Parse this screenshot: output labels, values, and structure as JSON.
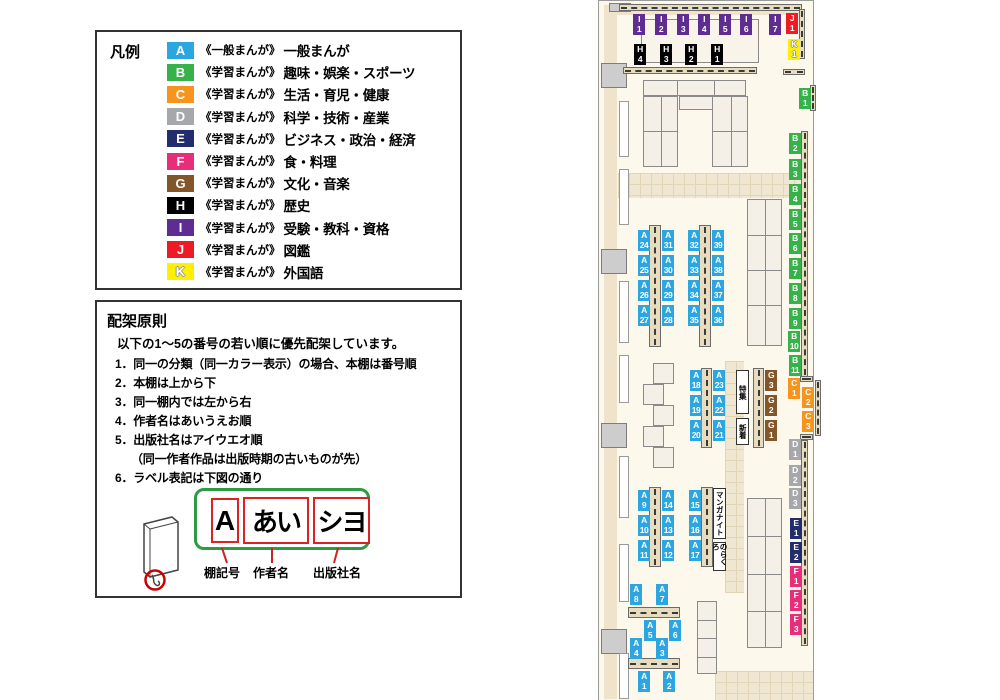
{
  "colors": {
    "A": "#2CA6E0",
    "B": "#35B24A",
    "C": "#F7941E",
    "D": "#A5A7AA",
    "E": "#232C6C",
    "F": "#E62E7B",
    "G": "#82552A",
    "H": "#000000",
    "I": "#5F2D91",
    "J": "#ED1C24",
    "K": "#FFF000"
  },
  "legend": {
    "title": "凡例",
    "items": [
      {
        "code": "A",
        "series": "《一般まんが》",
        "category": "一般まんが"
      },
      {
        "code": "B",
        "series": "《学習まんが》",
        "category": "趣味・娯楽・スポーツ"
      },
      {
        "code": "C",
        "series": "《学習まんが》",
        "category": "生活・育児・健康"
      },
      {
        "code": "D",
        "series": "《学習まんが》",
        "category": "科学・技術・産業"
      },
      {
        "code": "E",
        "series": "《学習まんが》",
        "category": "ビジネス・政治・経済"
      },
      {
        "code": "F",
        "series": "《学習まんが》",
        "category": "食・料理"
      },
      {
        "code": "G",
        "series": "《学習まんが》",
        "category": "文化・音楽"
      },
      {
        "code": "H",
        "series": "《学習まんが》",
        "category": "歴史"
      },
      {
        "code": "I",
        "series": "《学習まんが》",
        "category": "受験・教科・資格"
      },
      {
        "code": "J",
        "series": "《学習まんが》",
        "category": "図鑑"
      },
      {
        "code": "K",
        "series": "《学習まんが》",
        "category": "外国語",
        "light": true
      }
    ]
  },
  "principles": {
    "title": "配架原則",
    "intro": "以下の1～5の番号の若い順に優先配架しています。",
    "items": [
      {
        "t": "1．同一の分類（同一カラー表示）の場合、本棚は番号順"
      },
      {
        "t": "2．本棚は上から下"
      },
      {
        "t": "3．同一棚内では左から右"
      },
      {
        "t": "4．作者名はあいうえお順"
      },
      {
        "t": "5．出版社名はアイウエオ順"
      },
      {
        "t": "（同一作者作品は出版時期の古いものが先）",
        "indent": true
      },
      {
        "t": "6．ラベル表記は下図の通り"
      }
    ],
    "diagram": {
      "shelf_code": "A",
      "author": "あい",
      "publisher": "シヨ",
      "labels": [
        "棚記号",
        "作者名",
        "出版社名"
      ]
    }
  },
  "map": {
    "markers": [
      {
        "c": "I",
        "n": "1",
        "x": 34,
        "y": 13
      },
      {
        "c": "I",
        "n": "2",
        "x": 56,
        "y": 13
      },
      {
        "c": "I",
        "n": "3",
        "x": 78,
        "y": 13
      },
      {
        "c": "I",
        "n": "4",
        "x": 99,
        "y": 13
      },
      {
        "c": "I",
        "n": "5",
        "x": 120,
        "y": 13
      },
      {
        "c": "I",
        "n": "6",
        "x": 141,
        "y": 13
      },
      {
        "c": "I",
        "n": "7",
        "x": 170,
        "y": 13
      },
      {
        "c": "J",
        "n": "1",
        "x": 187,
        "y": 12
      },
      {
        "c": "K",
        "n": "1",
        "x": 189,
        "y": 38
      },
      {
        "c": "H",
        "n": "4",
        "x": 35,
        "y": 43
      },
      {
        "c": "H",
        "n": "3",
        "x": 61,
        "y": 43
      },
      {
        "c": "H",
        "n": "2",
        "x": 86,
        "y": 43
      },
      {
        "c": "H",
        "n": "1",
        "x": 112,
        "y": 43
      },
      {
        "c": "B",
        "n": "1",
        "x": 200,
        "y": 87
      },
      {
        "c": "B",
        "n": "2",
        "x": 190,
        "y": 132
      },
      {
        "c": "B",
        "n": "3",
        "x": 190,
        "y": 158
      },
      {
        "c": "B",
        "n": "4",
        "x": 190,
        "y": 183
      },
      {
        "c": "B",
        "n": "5",
        "x": 190,
        "y": 208
      },
      {
        "c": "B",
        "n": "6",
        "x": 190,
        "y": 232
      },
      {
        "c": "B",
        "n": "7",
        "x": 190,
        "y": 257
      },
      {
        "c": "B",
        "n": "8",
        "x": 190,
        "y": 282
      },
      {
        "c": "B",
        "n": "9",
        "x": 190,
        "y": 307
      },
      {
        "c": "B",
        "n": "10",
        "x": 189,
        "y": 330
      },
      {
        "c": "B",
        "n": "11",
        "x": 190,
        "y": 354
      },
      {
        "c": "C",
        "n": "1",
        "x": 189,
        "y": 377
      },
      {
        "c": "C",
        "n": "2",
        "x": 203,
        "y": 386
      },
      {
        "c": "C",
        "n": "3",
        "x": 203,
        "y": 410
      },
      {
        "c": "D",
        "n": "1",
        "x": 190,
        "y": 438
      },
      {
        "c": "D",
        "n": "2",
        "x": 190,
        "y": 464
      },
      {
        "c": "D",
        "n": "3",
        "x": 190,
        "y": 487
      },
      {
        "c": "E",
        "n": "1",
        "x": 191,
        "y": 517
      },
      {
        "c": "E",
        "n": "2",
        "x": 191,
        "y": 541
      },
      {
        "c": "F",
        "n": "1",
        "x": 191,
        "y": 565
      },
      {
        "c": "F",
        "n": "2",
        "x": 191,
        "y": 589
      },
      {
        "c": "F",
        "n": "3",
        "x": 191,
        "y": 613
      },
      {
        "c": "A",
        "n": "24",
        "x": 39,
        "y": 229
      },
      {
        "c": "A",
        "n": "25",
        "x": 39,
        "y": 254
      },
      {
        "c": "A",
        "n": "26",
        "x": 39,
        "y": 279
      },
      {
        "c": "A",
        "n": "27",
        "x": 39,
        "y": 304
      },
      {
        "c": "A",
        "n": "31",
        "x": 63,
        "y": 229
      },
      {
        "c": "A",
        "n": "30",
        "x": 63,
        "y": 254
      },
      {
        "c": "A",
        "n": "29",
        "x": 63,
        "y": 279
      },
      {
        "c": "A",
        "n": "28",
        "x": 63,
        "y": 304
      },
      {
        "c": "A",
        "n": "32",
        "x": 89,
        "y": 229
      },
      {
        "c": "A",
        "n": "33",
        "x": 89,
        "y": 254
      },
      {
        "c": "A",
        "n": "34",
        "x": 89,
        "y": 279
      },
      {
        "c": "A",
        "n": "35",
        "x": 89,
        "y": 304
      },
      {
        "c": "A",
        "n": "39",
        "x": 113,
        "y": 229
      },
      {
        "c": "A",
        "n": "38",
        "x": 113,
        "y": 254
      },
      {
        "c": "A",
        "n": "37",
        "x": 113,
        "y": 279
      },
      {
        "c": "A",
        "n": "36",
        "x": 113,
        "y": 304
      },
      {
        "c": "A",
        "n": "18",
        "x": 91,
        "y": 369
      },
      {
        "c": "A",
        "n": "19",
        "x": 91,
        "y": 394
      },
      {
        "c": "A",
        "n": "20",
        "x": 91,
        "y": 419
      },
      {
        "c": "A",
        "n": "23",
        "x": 114,
        "y": 369
      },
      {
        "c": "A",
        "n": "22",
        "x": 114,
        "y": 394
      },
      {
        "c": "A",
        "n": "21",
        "x": 114,
        "y": 419
      },
      {
        "c": "G",
        "n": "3",
        "x": 166,
        "y": 369
      },
      {
        "c": "G",
        "n": "2",
        "x": 166,
        "y": 394
      },
      {
        "c": "G",
        "n": "1",
        "x": 166,
        "y": 419
      },
      {
        "c": "A",
        "n": "9",
        "x": 39,
        "y": 489
      },
      {
        "c": "A",
        "n": "10",
        "x": 39,
        "y": 514
      },
      {
        "c": "A",
        "n": "11",
        "x": 39,
        "y": 539
      },
      {
        "c": "A",
        "n": "14",
        "x": 63,
        "y": 489
      },
      {
        "c": "A",
        "n": "13",
        "x": 63,
        "y": 514
      },
      {
        "c": "A",
        "n": "12",
        "x": 63,
        "y": 539
      },
      {
        "c": "A",
        "n": "15",
        "x": 90,
        "y": 489
      },
      {
        "c": "A",
        "n": "16",
        "x": 90,
        "y": 514
      },
      {
        "c": "A",
        "n": "17",
        "x": 90,
        "y": 539
      },
      {
        "c": "A",
        "n": "8",
        "x": 31,
        "y": 583
      },
      {
        "c": "A",
        "n": "7",
        "x": 57,
        "y": 583
      },
      {
        "c": "A",
        "n": "5",
        "x": 45,
        "y": 619
      },
      {
        "c": "A",
        "n": "6",
        "x": 70,
        "y": 619
      },
      {
        "c": "A",
        "n": "4",
        "x": 31,
        "y": 637
      },
      {
        "c": "A",
        "n": "3",
        "x": 57,
        "y": 637
      },
      {
        "c": "A",
        "n": "1",
        "x": 39,
        "y": 670
      },
      {
        "c": "A",
        "n": "2",
        "x": 64,
        "y": 670
      }
    ],
    "areas": [
      {
        "text": "特集",
        "x": 137,
        "y": 369,
        "w": 13,
        "h": 44
      },
      {
        "text": "新着",
        "x": 137,
        "y": 417,
        "w": 13,
        "h": 27
      },
      {
        "text": "マンガナイト",
        "x": 114,
        "y": 487,
        "w": 13,
        "h": 51
      },
      {
        "text": "のらくろ",
        "x": 114,
        "y": 541,
        "w": 13,
        "h": 29
      }
    ]
  }
}
